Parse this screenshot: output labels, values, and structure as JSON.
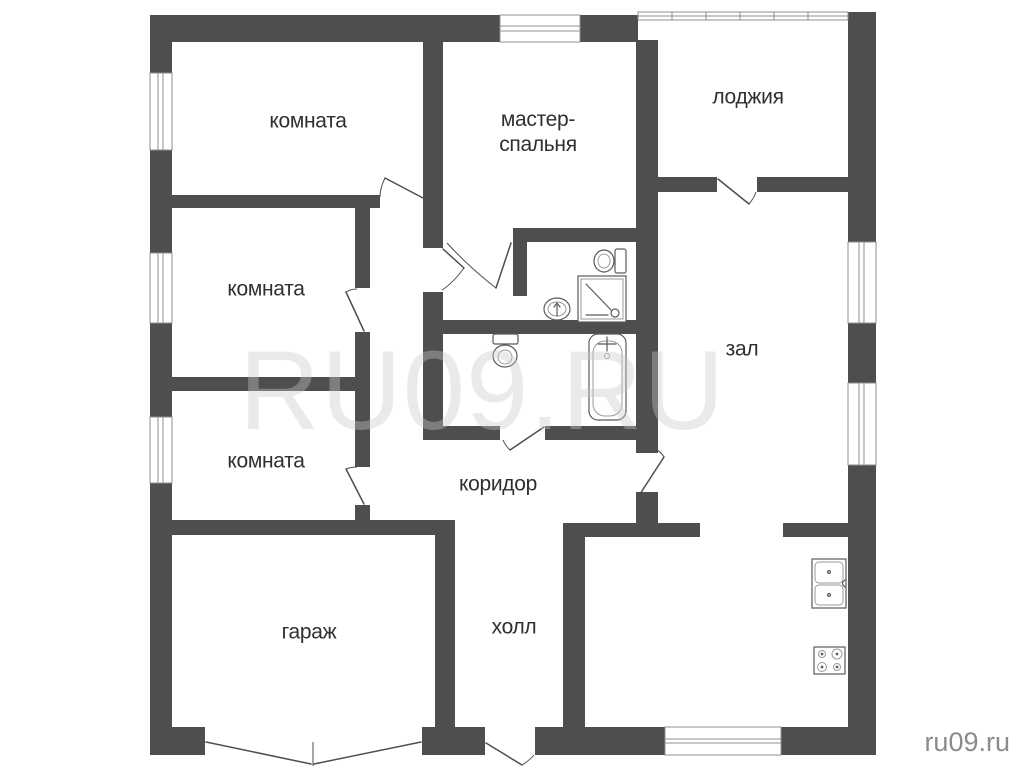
{
  "plan": {
    "type": "floor-plan",
    "language": "ru"
  },
  "rooms": [
    {
      "id": "room-top-left",
      "label": "комната"
    },
    {
      "id": "room-mid-left",
      "label": "комната"
    },
    {
      "id": "room-lower-left",
      "label": "комната"
    },
    {
      "id": "master-bedroom",
      "lines": [
        "мастер-",
        "спальня"
      ]
    },
    {
      "id": "loggia",
      "label": "лоджия"
    },
    {
      "id": "living-hall",
      "label": "зал"
    },
    {
      "id": "corridor",
      "label": "коридор"
    },
    {
      "id": "entry-hall",
      "label": "холл"
    },
    {
      "id": "garage",
      "label": "гараж"
    }
  ],
  "watermark": {
    "center_text": "RU09.RU",
    "corner_text": "ru09.ru"
  },
  "icons": [
    "toilet-icon",
    "shower-cabin-icon",
    "washbasin-icon",
    "bathtub-icon",
    "kitchen-sink-icon",
    "stove-icon",
    "window-icon",
    "door-icon"
  ],
  "colors": {
    "background": "#ffffff",
    "wall": "#4e4e4e",
    "frame_line": "#8f8f8f",
    "fixture_line": "#5a5a5a",
    "label_text": "#2f2f2f",
    "watermark_center": "#c9c9c9",
    "watermark_corner": "#8c8c8c"
  }
}
